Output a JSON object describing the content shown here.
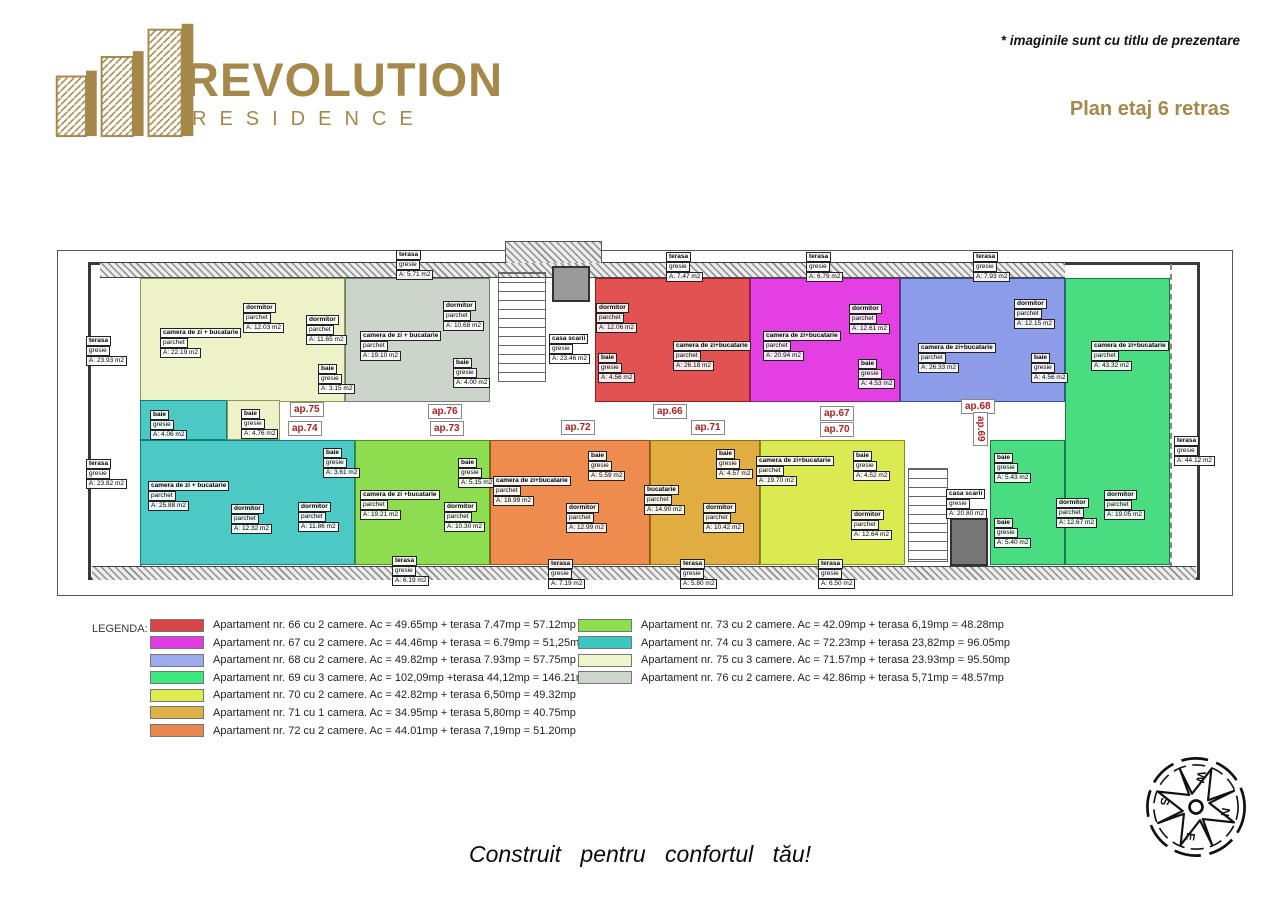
{
  "header": {
    "brand_name": "REVOLUTION",
    "brand_sub": "RESIDENCE",
    "disclaimer": "* imaginile sunt cu titlu de prezentare",
    "plan_title": "Plan etaj 6 retras"
  },
  "colors": {
    "brand_gold": "#a6884b",
    "ap_label_red": "#b02020"
  },
  "plan": {
    "units": [
      {
        "name": "ap.75",
        "color": "#edf2c8",
        "border": "#8a9a55",
        "rects": [
          [
            140,
            278,
            205,
            124
          ],
          [
            227,
            400,
            53,
            40
          ]
        ],
        "rooms": [
          {
            "lines": [
              "camera de zi + bucatarie",
              "parchet",
              "A: 22.19 m2"
            ],
            "x": 160,
            "y": 328
          },
          {
            "lines": [
              "dormitor",
              "parchet",
              "A: 12.03 m2"
            ],
            "x": 243,
            "y": 303
          },
          {
            "lines": [
              "dormitor",
              "parchet",
              "A: 11.65 m2"
            ],
            "x": 306,
            "y": 315
          },
          {
            "lines": [
              "baie",
              "gresie",
              "A: 3.15 m2"
            ],
            "x": 318,
            "y": 364
          },
          {
            "lines": [
              "baie",
              "gresie",
              "A: 4.76 m2"
            ],
            "x": 241,
            "y": 409
          }
        ]
      },
      {
        "name": "ap.76",
        "color": "#ccd4cb",
        "border": "#708070",
        "rects": [
          [
            345,
            278,
            145,
            124
          ]
        ],
        "rooms": [
          {
            "lines": [
              "camera de zi + bucatarie",
              "parchet",
              "A: 19.10 m2"
            ],
            "x": 360,
            "y": 331
          },
          {
            "lines": [
              "dormitor",
              "parchet",
              "A: 10.68 m2"
            ],
            "x": 443,
            "y": 301
          },
          {
            "lines": [
              "baie",
              "gresie",
              "A: 4.00 m2"
            ],
            "x": 453,
            "y": 358
          }
        ]
      },
      {
        "name": "ap.66",
        "color": "#e25252",
        "border": "#991c1c",
        "rects": [
          [
            595,
            278,
            155,
            124
          ]
        ],
        "rooms": [
          {
            "lines": [
              "dormitor",
              "parchet",
              "A: 12.06 m2"
            ],
            "x": 596,
            "y": 303
          },
          {
            "lines": [
              "baie",
              "gresie",
              "A: 4.56 m2"
            ],
            "x": 598,
            "y": 353
          },
          {
            "lines": [
              "camera de zi+bucatarie",
              "parchet",
              "A: 26.18 m2"
            ],
            "x": 673,
            "y": 341
          }
        ]
      },
      {
        "name": "ap.67",
        "color": "#e33fe3",
        "border": "#8c1c8c",
        "rects": [
          [
            750,
            278,
            150,
            124
          ]
        ],
        "rooms": [
          {
            "lines": [
              "camera de zi+bucatarie",
              "parchet",
              "A: 20.94 m2"
            ],
            "x": 763,
            "y": 331
          },
          {
            "lines": [
              "dormitor",
              "parchet",
              "A: 12.61 m2"
            ],
            "x": 849,
            "y": 304
          },
          {
            "lines": [
              "baie",
              "gresie",
              "A: 4.53 m2"
            ],
            "x": 858,
            "y": 359
          }
        ]
      },
      {
        "name": "ap.68",
        "color": "#8d9ce9",
        "border": "#3a4aa0",
        "rects": [
          [
            900,
            278,
            165,
            124
          ]
        ],
        "rooms": [
          {
            "lines": [
              "camera de zi+bucatarie",
              "parchet",
              "A: 26.33 m2"
            ],
            "x": 918,
            "y": 343
          },
          {
            "lines": [
              "dormitor",
              "parchet",
              "A: 12.15 m2"
            ],
            "x": 1014,
            "y": 299
          },
          {
            "lines": [
              "baie",
              "gresie",
              "A: 4.56 m2"
            ],
            "x": 1031,
            "y": 353
          }
        ]
      },
      {
        "name": "ap.69",
        "color": "#4adc80",
        "border": "#148040",
        "rects": [
          [
            1065,
            278,
            105,
            287
          ],
          [
            990,
            440,
            75,
            125
          ]
        ],
        "rooms": [
          {
            "lines": [
              "camera de zi+bucatarie",
              "parchet",
              "A: 43.32 m2"
            ],
            "x": 1091,
            "y": 341
          },
          {
            "lines": [
              "baie",
              "gresie",
              "A: 5.43 m2"
            ],
            "x": 994,
            "y": 453
          },
          {
            "lines": [
              "baie",
              "gresie",
              "A: 5.40 m2"
            ],
            "x": 994,
            "y": 518
          },
          {
            "lines": [
              "dormitor",
              "parchet",
              "A: 12.67 m2"
            ],
            "x": 1056,
            "y": 498
          },
          {
            "lines": [
              "dormitor",
              "parchet",
              "A: 19.05 m2"
            ],
            "x": 1104,
            "y": 490
          }
        ]
      },
      {
        "name": "ap.74",
        "color": "#4cc9c5",
        "border": "#0f7f7f",
        "rects": [
          [
            140,
            440,
            215,
            125
          ],
          [
            140,
            400,
            87,
            40
          ]
        ],
        "rooms": [
          {
            "lines": [
              "baie",
              "gresie",
              "A: 4.06 m2"
            ],
            "x": 150,
            "y": 410
          },
          {
            "lines": [
              "camera de zi + bucatarie",
              "parchet",
              "A: 25.88 m2"
            ],
            "x": 148,
            "y": 481
          },
          {
            "lines": [
              "dormitor",
              "parchet",
              "A: 12.32 m2"
            ],
            "x": 231,
            "y": 504
          },
          {
            "lines": [
              "dormitor",
              "parchet",
              "A: 11.86 m2"
            ],
            "x": 298,
            "y": 502
          },
          {
            "lines": [
              "baie",
              "gresie",
              "A: 3.61 m2"
            ],
            "x": 323,
            "y": 448
          }
        ]
      },
      {
        "name": "ap.73",
        "color": "#8edc50",
        "border": "#4f8f14",
        "rects": [
          [
            355,
            440,
            135,
            125
          ]
        ],
        "rooms": [
          {
            "lines": [
              "camera de zi +bucatarie",
              "parchet",
              "A: 19.21 m2"
            ],
            "x": 360,
            "y": 490
          },
          {
            "lines": [
              "baie",
              "gresie",
              "A: 5.15 m2"
            ],
            "x": 458,
            "y": 458
          },
          {
            "lines": [
              "dormitor",
              "parchet",
              "A: 10.30 m2"
            ],
            "x": 444,
            "y": 502
          }
        ]
      },
      {
        "name": "ap.72",
        "color": "#ee8c50",
        "border": "#9c4f14",
        "rects": [
          [
            490,
            440,
            160,
            125
          ]
        ],
        "rooms": [
          {
            "lines": [
              "camera de zi+bucatarie",
              "parchet",
              "A: 18.99 m2"
            ],
            "x": 493,
            "y": 476
          },
          {
            "lines": [
              "baie",
              "gresie",
              "A: 5.59 m2"
            ],
            "x": 588,
            "y": 451
          },
          {
            "lines": [
              "dormitor",
              "parchet",
              "A: 12.99 m2"
            ],
            "x": 566,
            "y": 503
          }
        ]
      },
      {
        "name": "ap.71",
        "color": "#e2ad40",
        "border": "#8f6f14",
        "rects": [
          [
            650,
            440,
            110,
            125
          ]
        ],
        "rooms": [
          {
            "lines": [
              "bucatarie",
              "parchet",
              "A: 14.90 m2"
            ],
            "x": 644,
            "y": 485
          },
          {
            "lines": [
              "baie",
              "gresie",
              "A: 4.57 m2"
            ],
            "x": 716,
            "y": 449
          },
          {
            "lines": [
              "dormitor",
              "parchet",
              "A: 10.42 m2"
            ],
            "x": 703,
            "y": 503
          }
        ]
      },
      {
        "name": "ap.70",
        "color": "#dcea52",
        "border": "#808f1c",
        "rects": [
          [
            760,
            440,
            145,
            125
          ]
        ],
        "rooms": [
          {
            "lines": [
              "camera de zi+bucatarie",
              "parchet",
              "A: 19.70 m2"
            ],
            "x": 756,
            "y": 456
          },
          {
            "lines": [
              "baie",
              "gresie",
              "A: 4.52 m2"
            ],
            "x": 853,
            "y": 451
          },
          {
            "lines": [
              "dormitor",
              "parchet",
              "A: 12.64 m2"
            ],
            "x": 851,
            "y": 510
          }
        ]
      }
    ],
    "stairwells": [
      {
        "lines": [
          "casa scarii",
          "gresie",
          "A: 23.46 m2"
        ],
        "x": 549,
        "y": 334
      },
      {
        "lines": [
          "casa scarii",
          "gresie",
          "A: 20.80 m2"
        ],
        "x": 946,
        "y": 489
      }
    ],
    "terraces": [
      {
        "lines": [
          "terasa",
          "gresie",
          "A: 23.93 m2"
        ],
        "x": 86,
        "y": 336
      },
      {
        "lines": [
          "terasa",
          "gresie",
          "A: 23.82 m2"
        ],
        "x": 86,
        "y": 459
      },
      {
        "lines": [
          "terasa",
          "gresie",
          "A: 5.71 m2"
        ],
        "x": 396,
        "y": 250
      },
      {
        "lines": [
          "terasa",
          "gresie",
          "A: 7.47 m2"
        ],
        "x": 666,
        "y": 252
      },
      {
        "lines": [
          "terasa",
          "gresie",
          "A: 6.79 m2"
        ],
        "x": 806,
        "y": 252
      },
      {
        "lines": [
          "terasa",
          "gresie",
          "A: 7.93 m2"
        ],
        "x": 973,
        "y": 252
      },
      {
        "lines": [
          "terasa",
          "gresie",
          "A: 44.12 m2"
        ],
        "x": 1174,
        "y": 436
      },
      {
        "lines": [
          "terasa",
          "gresie",
          "A: 6.19 m2"
        ],
        "x": 392,
        "y": 556
      },
      {
        "lines": [
          "terasa",
          "gresie",
          "A: 7.19 m2"
        ],
        "x": 548,
        "y": 559
      },
      {
        "lines": [
          "terasa",
          "gresie",
          "A: 5.80 m2"
        ],
        "x": 680,
        "y": 559
      },
      {
        "lines": [
          "terasa",
          "gresie",
          "A: 6.50 m2"
        ],
        "x": 818,
        "y": 559
      }
    ],
    "ap_labels": [
      {
        "text": "ap.75",
        "x": 290,
        "y": 402
      },
      {
        "text": "ap.76",
        "x": 428,
        "y": 404
      },
      {
        "text": "ap.66",
        "x": 653,
        "y": 404
      },
      {
        "text": "ap.67",
        "x": 820,
        "y": 406
      },
      {
        "text": "ap.68",
        "x": 961,
        "y": 399
      },
      {
        "text": "ap.74",
        "x": 288,
        "y": 421
      },
      {
        "text": "ap.73",
        "x": 430,
        "y": 421
      },
      {
        "text": "ap.72",
        "x": 561,
        "y": 420
      },
      {
        "text": "ap.71",
        "x": 691,
        "y": 420
      },
      {
        "text": "ap.70",
        "x": 820,
        "y": 422
      },
      {
        "text": "ap.69",
        "x": 988,
        "y": 412,
        "vertical": true
      }
    ]
  },
  "legend": {
    "title": "LEGENDA:",
    "left": [
      {
        "color": "#d94444",
        "text": "Apartament nr. 66 cu 2 camere. Ac = 49.65mp + terasa 7.47mp = 57.12mp"
      },
      {
        "color": "#e13ce1",
        "text": "Apartament nr. 67 cu 2 camere. Ac = 44.46mp + terasa = 6.79mp = 51,25mp"
      },
      {
        "color": "#9cabee",
        "text": "Apartament nr. 68 cu 2 camere. Ac = 49.82mp + terasa 7.93mp = 57.75mp"
      },
      {
        "color": "#3ce97e",
        "text": "Apartament nr. 69 cu 3 camere. Ac = 102,09mp +terasa 44,12mp = 146.21mp"
      },
      {
        "color": "#dcec50",
        "text": "Apartament nr. 70 cu 2 camere. Ac = 42.82mp + terasa 6,50mp = 49.32mp"
      },
      {
        "color": "#e0b048",
        "text": "Apartament nr. 71 cu 1 camera. Ac = 34.95mp + terasa 5,80mp = 40.75mp"
      },
      {
        "color": "#e8884e",
        "text": "Apartament nr. 72 cu 2 camere. Ac = 44.01mp + terasa 7,19mp = 51.20mp"
      }
    ],
    "right": [
      {
        "color": "#8ce04c",
        "text": "Apartament nr. 73 cu 2 camere. Ac = 42.09mp + terasa 6,19mp = 48.28mp"
      },
      {
        "color": "#3cc8c0",
        "text": "Apartament nr. 74 cu 3 camere. Ac = 72.23mp + terasa 23,82mp = 96.05mp"
      },
      {
        "color": "#f0f4cc",
        "text": "Apartament nr. 75 cu 3 camere. Ac = 71.57mp + terasa 23.93mp = 95.50mp"
      },
      {
        "color": "#cdd5cd",
        "text": "Apartament nr. 76 cu 2 camere. Ac = 42.86mp + terasa 5,71mp = 48.57mp"
      }
    ]
  },
  "compass": {
    "n": "N",
    "e": "E",
    "s": "S",
    "w": "W"
  },
  "footer": {
    "tagline": "Construit pentru confortul tău!"
  }
}
